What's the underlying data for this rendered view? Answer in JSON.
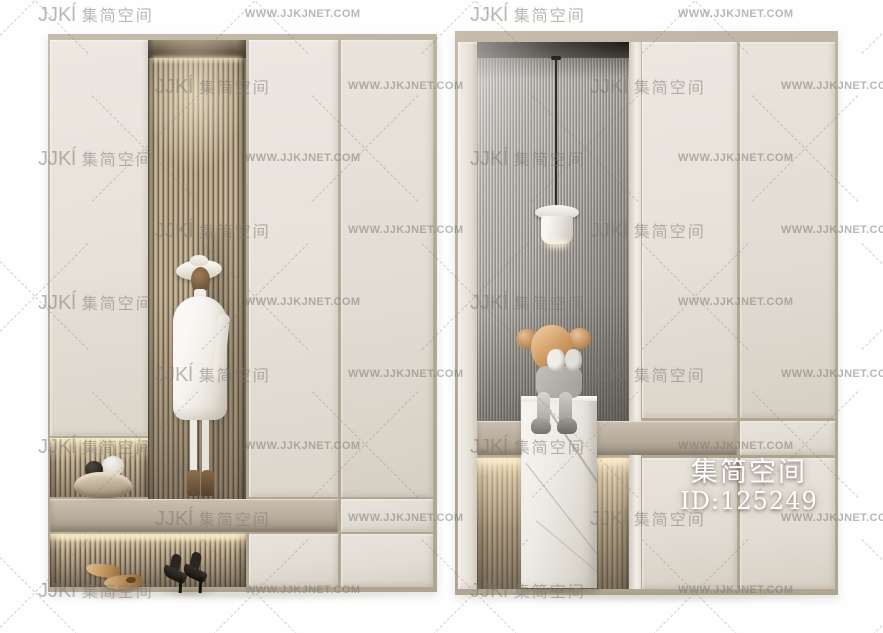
{
  "watermark": {
    "logo": "JJKĺ",
    "brand": "集简空间",
    "url": "WWW.JJKJNET.COM"
  },
  "badge": {
    "brand": "集简空间",
    "id": "ID:125249"
  },
  "colors": {
    "frame": "#b0a593",
    "panel_cream": "#e9e4dc",
    "panel_cream_dark": "#ddd7cc",
    "slat_light": "#dccbae",
    "slat_dark": "#70614e",
    "flute_light": "#c6c3be",
    "flute_dark": "#8d8983",
    "bench_band": "#b8ad9d",
    "led_glow": "#ffeec8",
    "marble": "#f4f1ec",
    "kaws_head": "#cf9a62",
    "mannequin_white": "#f6f4ef",
    "watermark_text": "#7d776e",
    "badge_text": "#ffffff"
  }
}
